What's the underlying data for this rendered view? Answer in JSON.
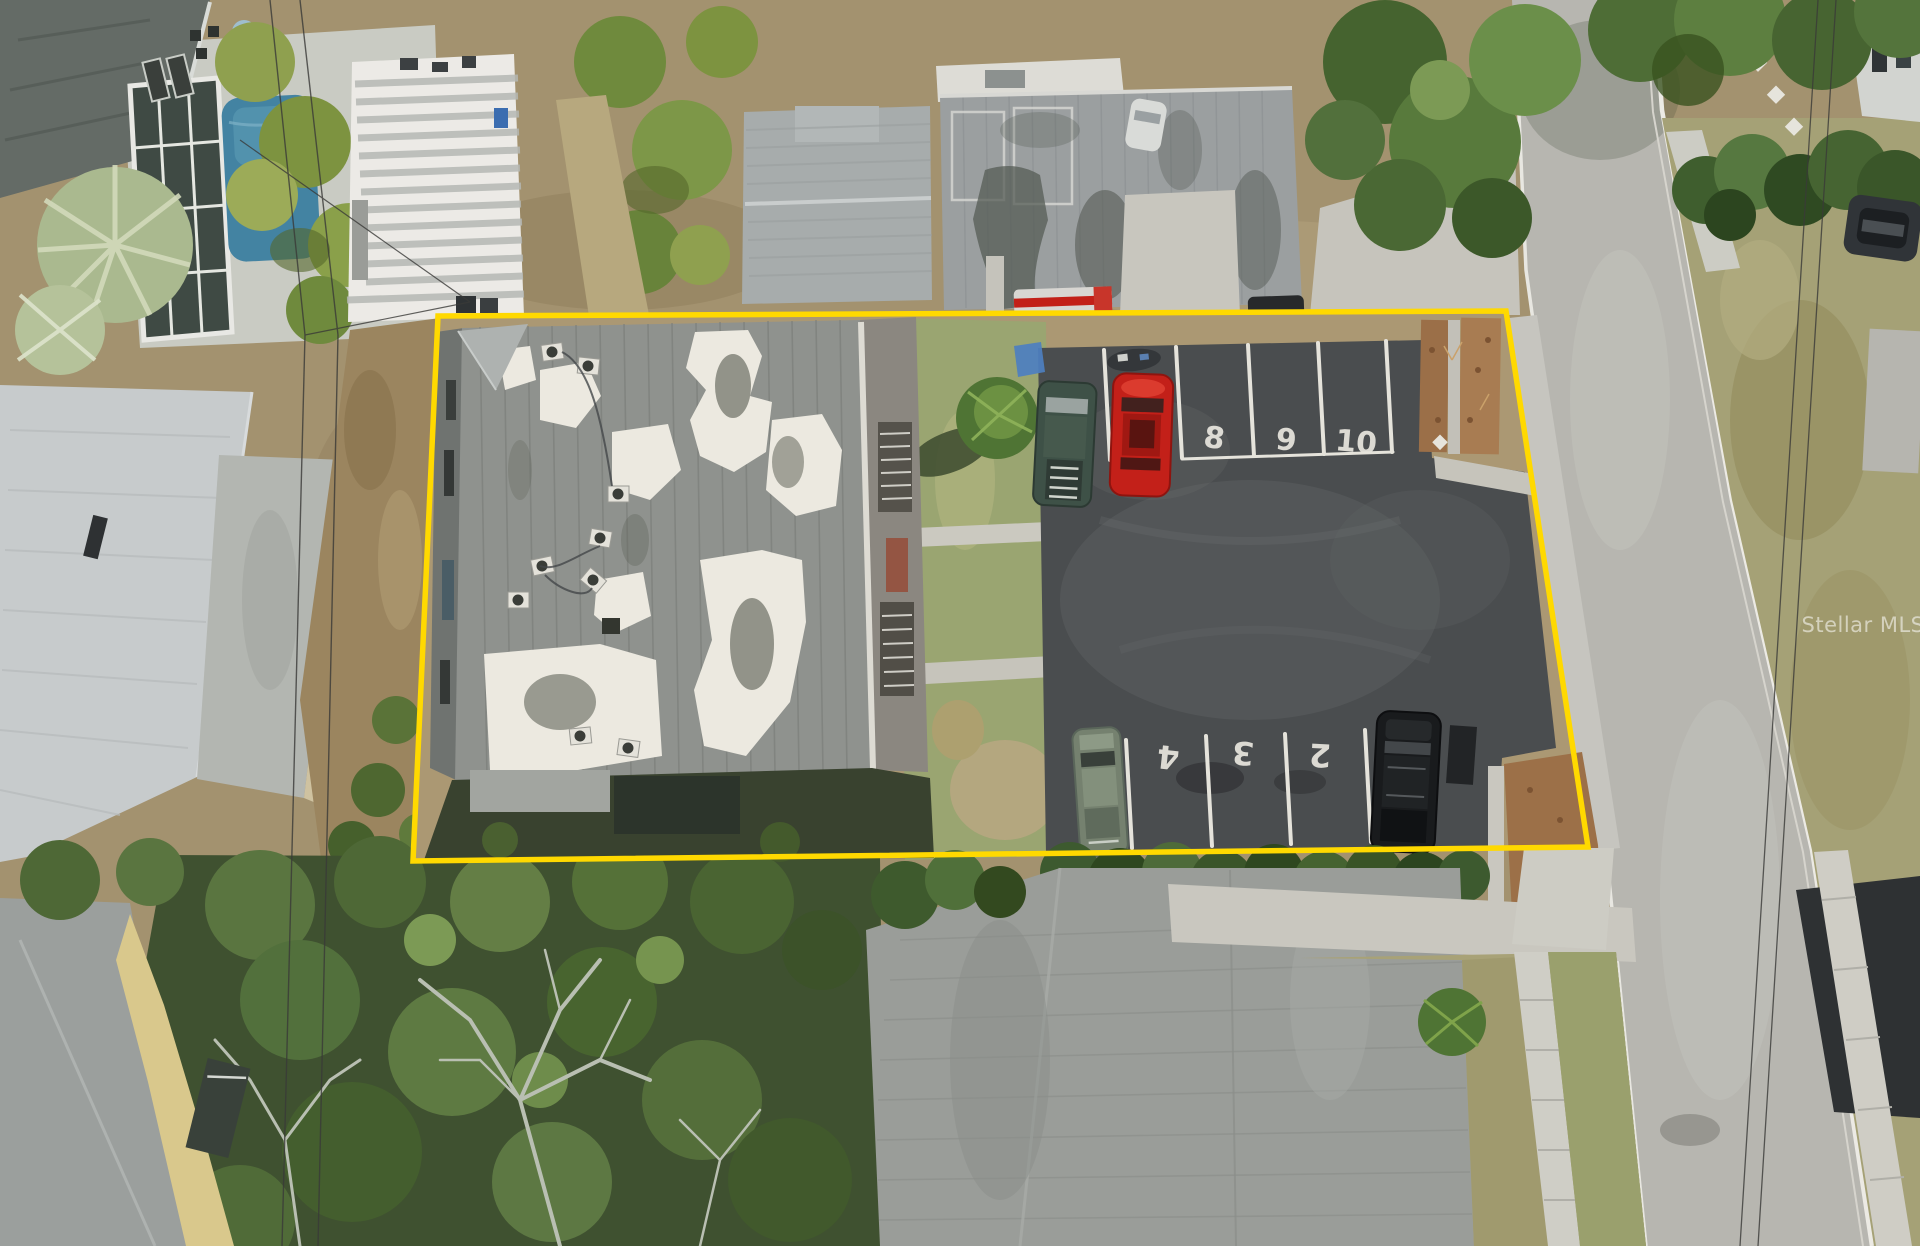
{
  "scene": {
    "type": "aerial-drone-real-estate-photo",
    "subject": "multifamily building with flat patched roof and striped parking lot outlined in yellow"
  },
  "watermark": {
    "text": "Stellar MLS",
    "color": "rgba(255,255,255,0.55)"
  },
  "boundary": {
    "color": "#FFD900"
  },
  "parking": {
    "top_labels": [
      "8",
      "9",
      "10"
    ],
    "bottom_labels": [
      "4",
      "3",
      "2"
    ],
    "stripe_color": "#E5E3DB"
  },
  "palette": {
    "asphalt": "#4A4D4F",
    "road_concrete": "#B7B6B0",
    "building_roof_gray": "#8F928E",
    "roof_patch_white": "#ECE9E0",
    "grass_olive": "#9AA571",
    "dirt_tan": "#A89272",
    "mulch_brown": "#9B6F48",
    "hedge_green": "#3D5A2F",
    "pool_blue": "#4383A2",
    "red_car": "#C32019",
    "green_suv": "#3E5147",
    "black_suv": "#191B1D",
    "sage_sedan": "#75816F"
  }
}
